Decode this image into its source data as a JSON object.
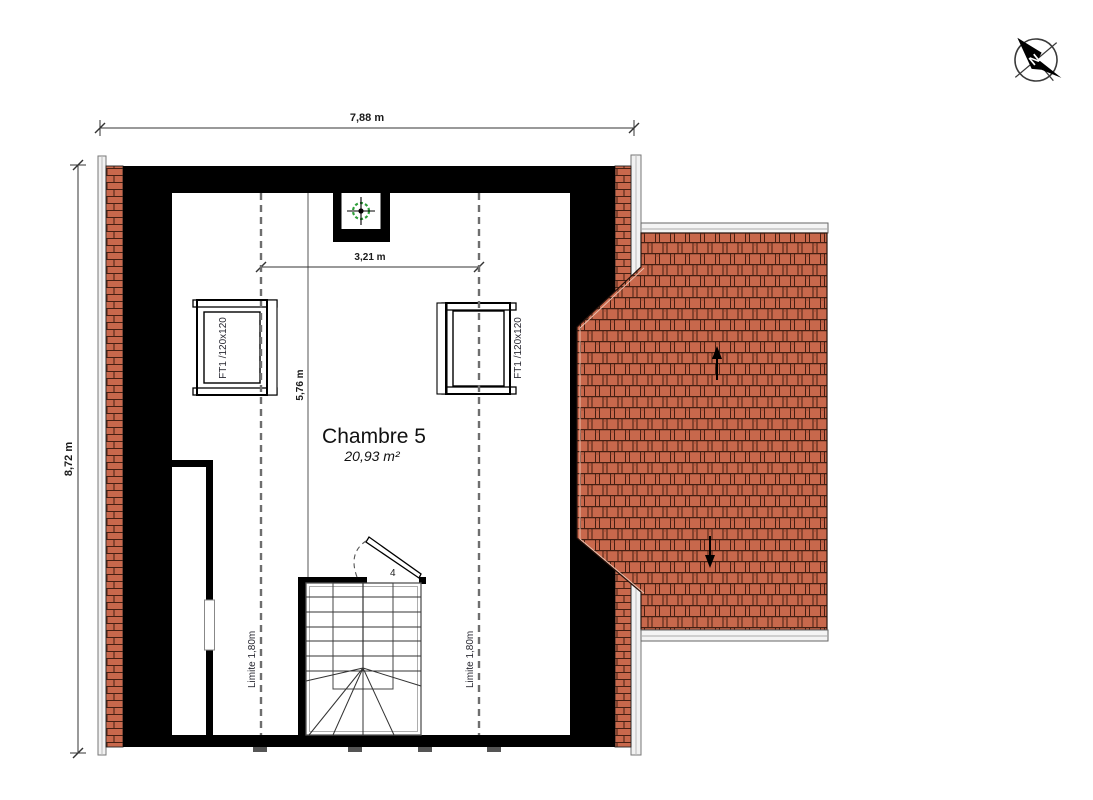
{
  "drawing": {
    "compass_label": "N",
    "dim_width_total": "7,88 m",
    "dim_height_total": "8,72 m",
    "dim_inner_width": "3,21 m",
    "dim_inner_height": "5,76 m",
    "room_name": "Chambre 5",
    "room_area": "20,93 m²",
    "window_left_label": "FT1 /120x120",
    "window_right_label": "FT1 /120x120",
    "limit_left_label": "Limite 1,80m",
    "limit_right_label": "Limite 1,80m",
    "stair_door_label": "4"
  },
  "colors": {
    "roof_tile": "#c8684c",
    "roof_tile_stroke": "#451f12",
    "wall": "#000000",
    "skylight_target_green": "#2e9e3a",
    "annotation_text": "#1a1a1a"
  }
}
